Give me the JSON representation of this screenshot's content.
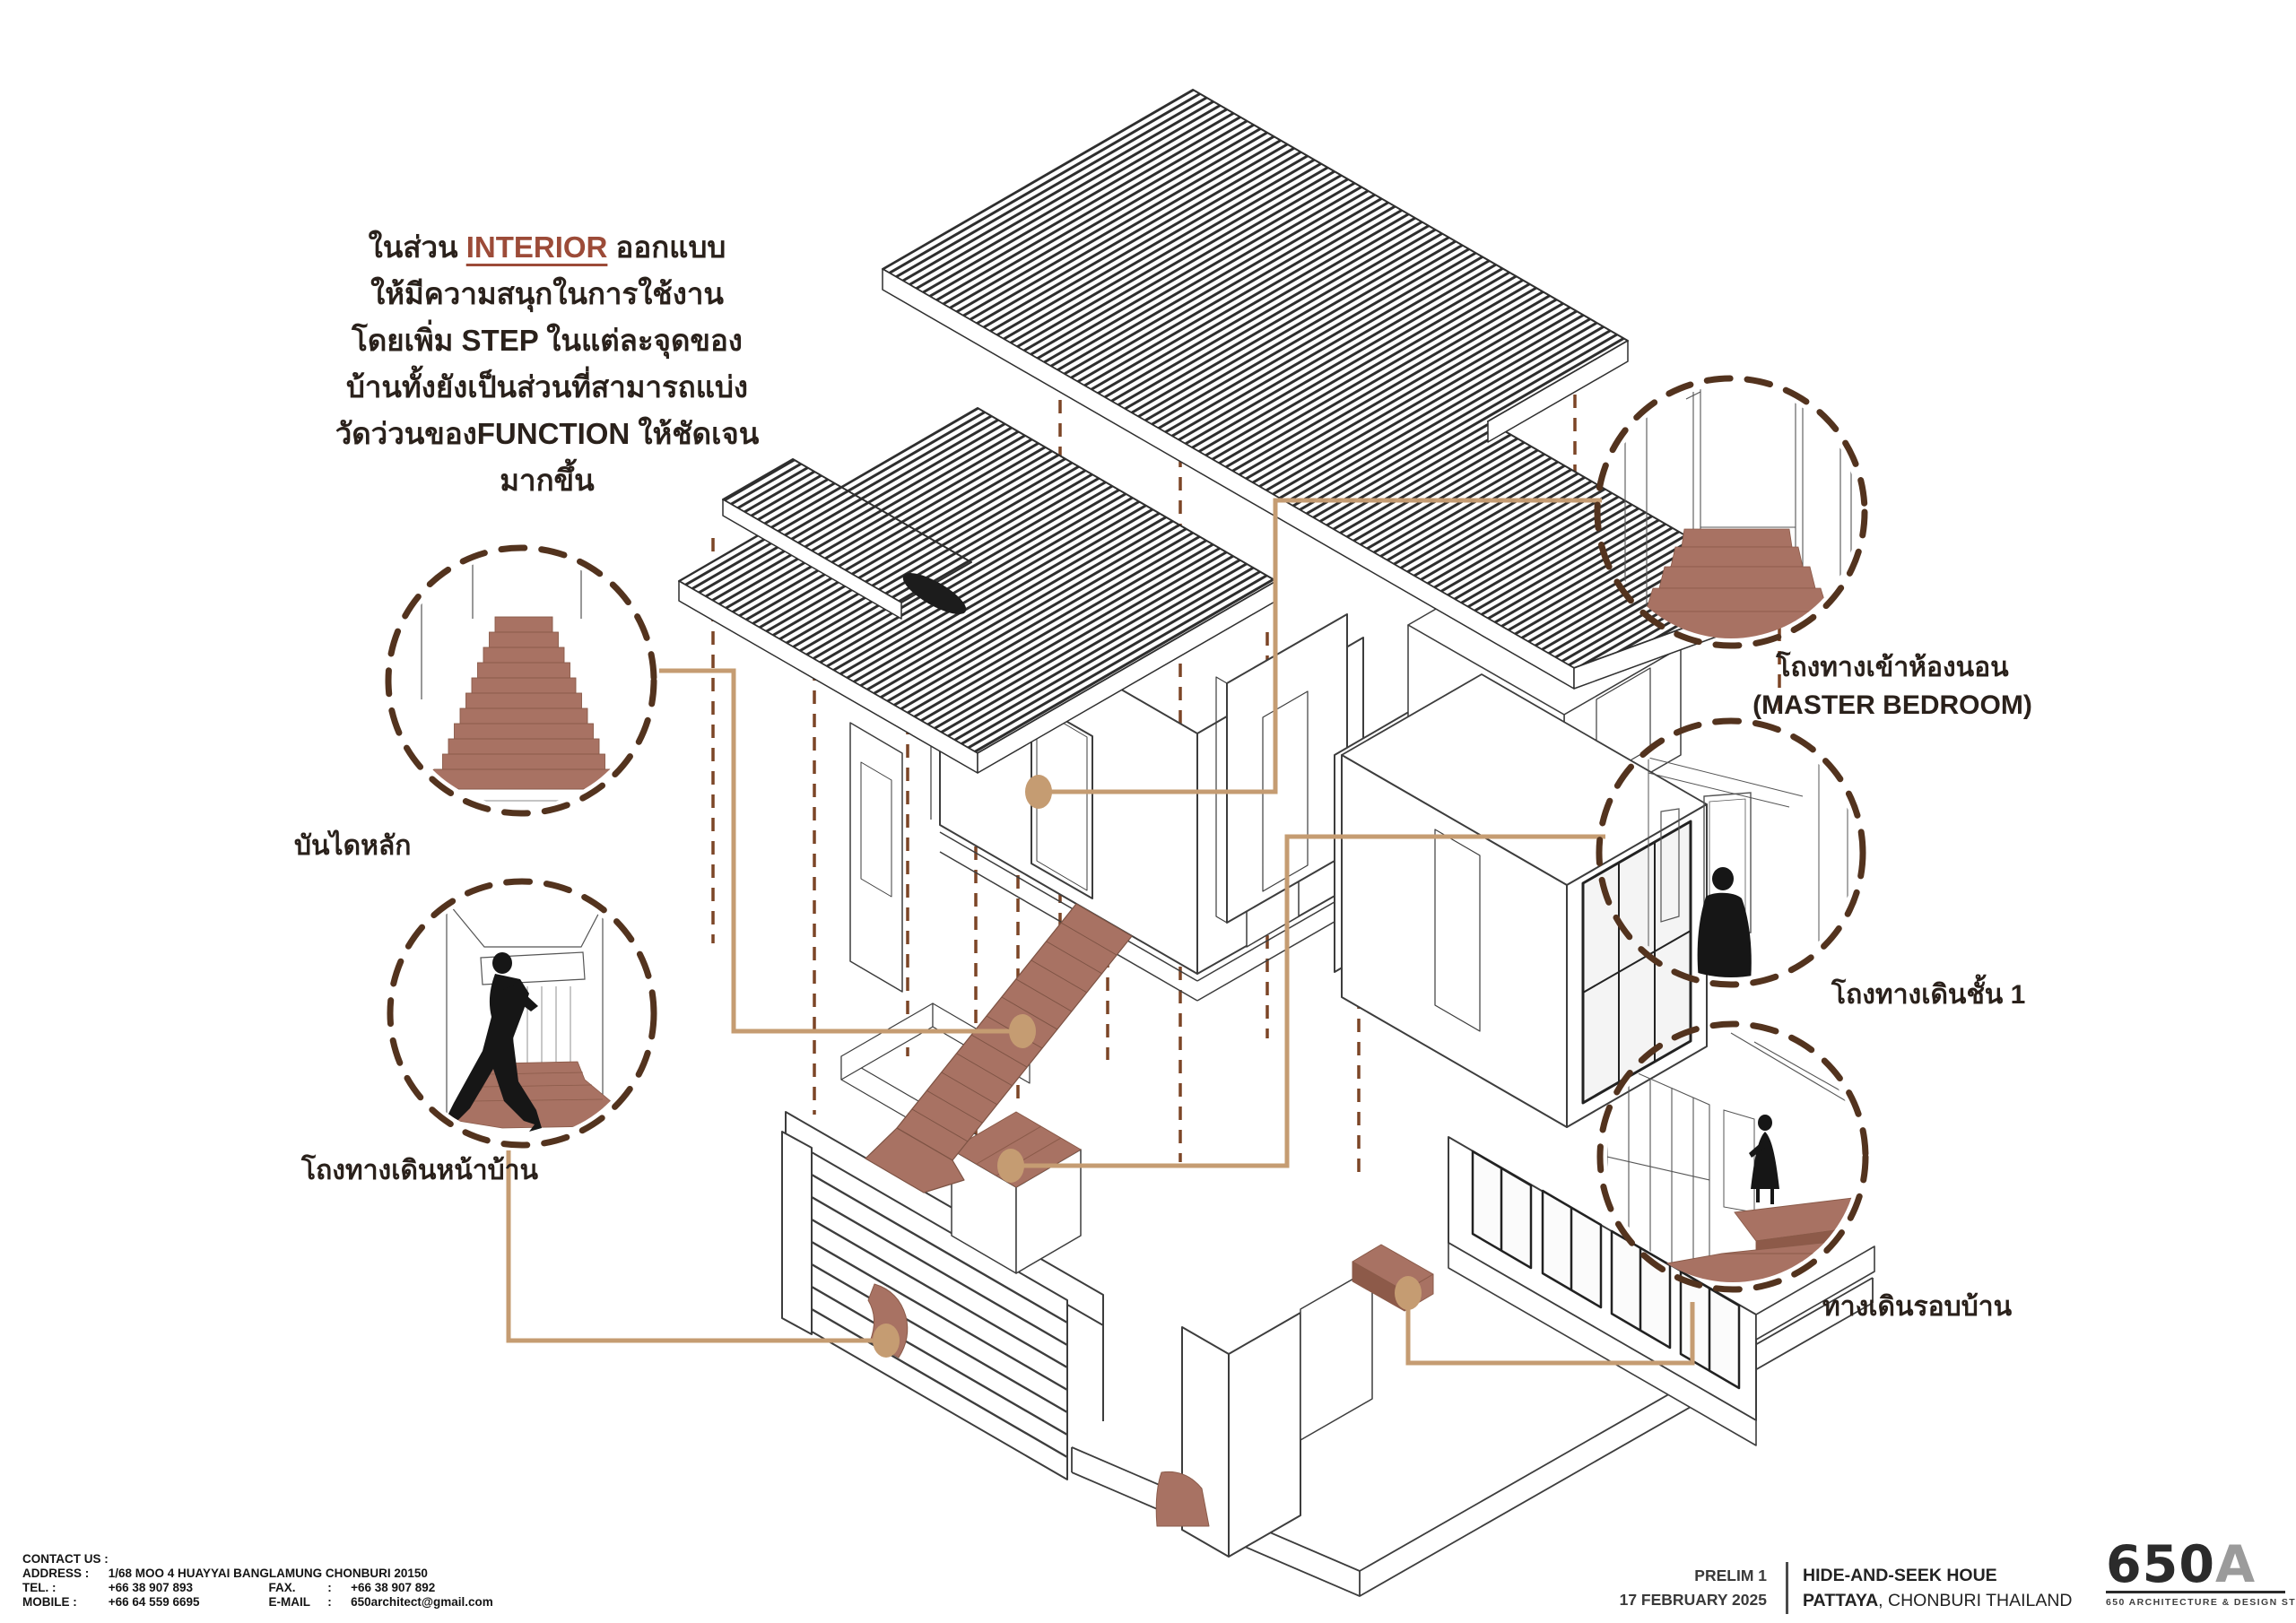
{
  "paragraph": {
    "line1_pre": "ในส่วน ",
    "line1_highlight": "INTERIOR",
    "line1_post": " ออกแบบ",
    "line2": "ให้มีความสนุกในการใช้งาน",
    "line3": "โดยเพิ่ม STEP ในแต่ละจุดของ",
    "line4": "บ้านทั้งยังเป็นส่วนที่สามารถแบ่ง",
    "line5": "วัดว่วนของFUNCTION ให้ชัดเจน",
    "line6": "มากขึ้น"
  },
  "callouts": {
    "main_stair": {
      "label": "บันไดหลัก"
    },
    "front_hallway": {
      "label": "โถงทางเดินหน้าบ้าน"
    },
    "master_bedroom_entry": {
      "label_line1": "โถงทางเข้าห้องนอน",
      "label_line2": "(MASTER BEDROOM)"
    },
    "first_floor_hallway": {
      "label": "โถงทางเดินชั้น 1"
    },
    "walkway_around_house": {
      "label": "ทางเดินรอบบ้าน"
    }
  },
  "contact": {
    "heading": "CONTACT US :",
    "address_label": "ADDRESS :",
    "address_value": "1/68 MOO 4 HUAYYAI BANGLAMUNG CHONBURI 20150",
    "tel_label": "TEL. :",
    "tel_value": "+66 38 907 893",
    "fax_label": "FAX.",
    "fax_sep": ":",
    "fax_value": "+66 38 907 892",
    "mobile_label": "MOBILE :",
    "mobile_value": "+66 64 559 6695",
    "email_label": "E-MAIL",
    "email_sep": ":",
    "email_value": "650architect@gmail.com"
  },
  "titleblock": {
    "phase": "PRELIM 1",
    "date": "17 FEBRUARY 2025",
    "project_name": "HIDE-AND-SEEK HOUE",
    "location_bold": "PATTAYA",
    "location_rest": ", CHONBURI THAILAND"
  },
  "logo": {
    "mark_main": "650",
    "mark_accent": "A",
    "tagline": "650 ARCHITECTURE & DESIGN STUDIO"
  },
  "colors": {
    "terracotta_fill": "#A87263",
    "terracotta_edge": "#8A5A49",
    "dashed_circle": "#53331E",
    "projection_line": "#7C4526",
    "connector_tan": "#C59C72",
    "highlight_text": "#9C4B38",
    "linework": "#3D3D3D",
    "logo_gray": "#9B9B9B"
  }
}
